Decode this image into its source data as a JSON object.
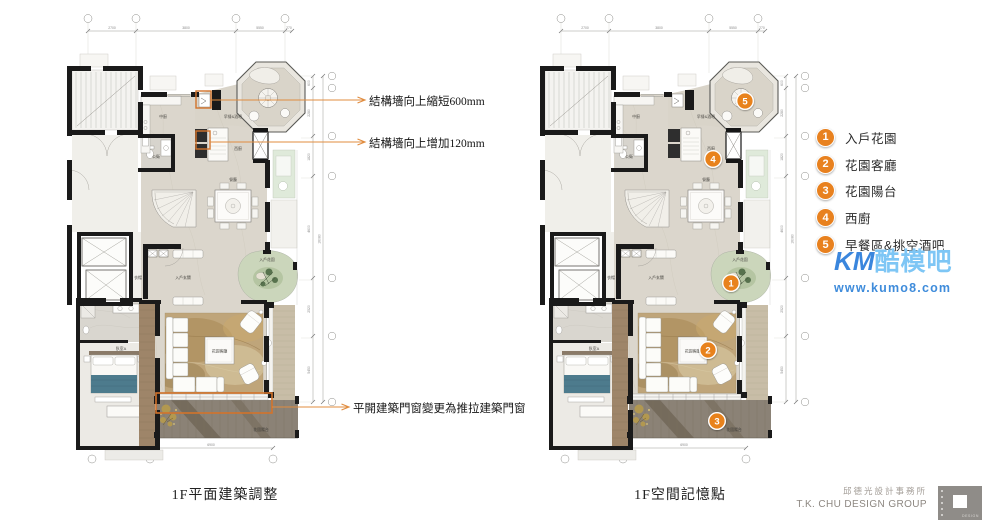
{
  "captions": {
    "left": "1F平面建築調整",
    "right": "1F空間記憶點"
  },
  "annotations": {
    "items": [
      {
        "text": "結構墻向上縮短600mm"
      },
      {
        "text": "結構墻向上增加120mm"
      },
      {
        "text": "平開建築門窗變更為推拉建築門窗"
      }
    ]
  },
  "legend": {
    "items": [
      {
        "num": "1",
        "label": "入戶花園"
      },
      {
        "num": "2",
        "label": "花園客廳"
      },
      {
        "num": "3",
        "label": "花園陽台"
      },
      {
        "num": "4",
        "label": "西廚"
      },
      {
        "num": "5",
        "label": "早餐區&挑空酒吧"
      }
    ]
  },
  "plan": {
    "rooms": {
      "kitchen": "中廚",
      "breakfast_bar": "早餐&酒吧",
      "west_kitchen": "西廚",
      "dining": "餐廳",
      "bath": "公衛",
      "cloak": "衣帽",
      "foyer": "入戶玄關",
      "entry_garden": "入戶花園",
      "garden_living": "花園客廳",
      "bedroom_a": "臥室A",
      "garden_balcony": "花園陽台"
    },
    "dims": {
      "top": [
        "2700",
        "3800",
        "5550",
        "270"
      ],
      "right": [
        "600",
        "2280",
        "1820",
        "4600",
        "2520",
        "5450"
      ],
      "right_overall": "16080",
      "bottom": [
        "3300",
        "6900"
      ]
    }
  },
  "watermark": {
    "brand_prefix": "KM",
    "brand_suffix": "酷模吧",
    "url": "www.kumo8.com"
  },
  "firm": {
    "name_cn": "邱德光設計事務所",
    "name_en": "T.K. CHU DESIGN GROUP",
    "logo_text": "DESIGN"
  },
  "colors": {
    "annotation_orange": "#E08C3F",
    "marker_orange": "#E8811F",
    "wall_black": "#1a1a1a",
    "floor_beige": "#dbd6cc",
    "watermark_blue": "#3a86dd",
    "watermark_light_blue": "#7ec6f5"
  }
}
